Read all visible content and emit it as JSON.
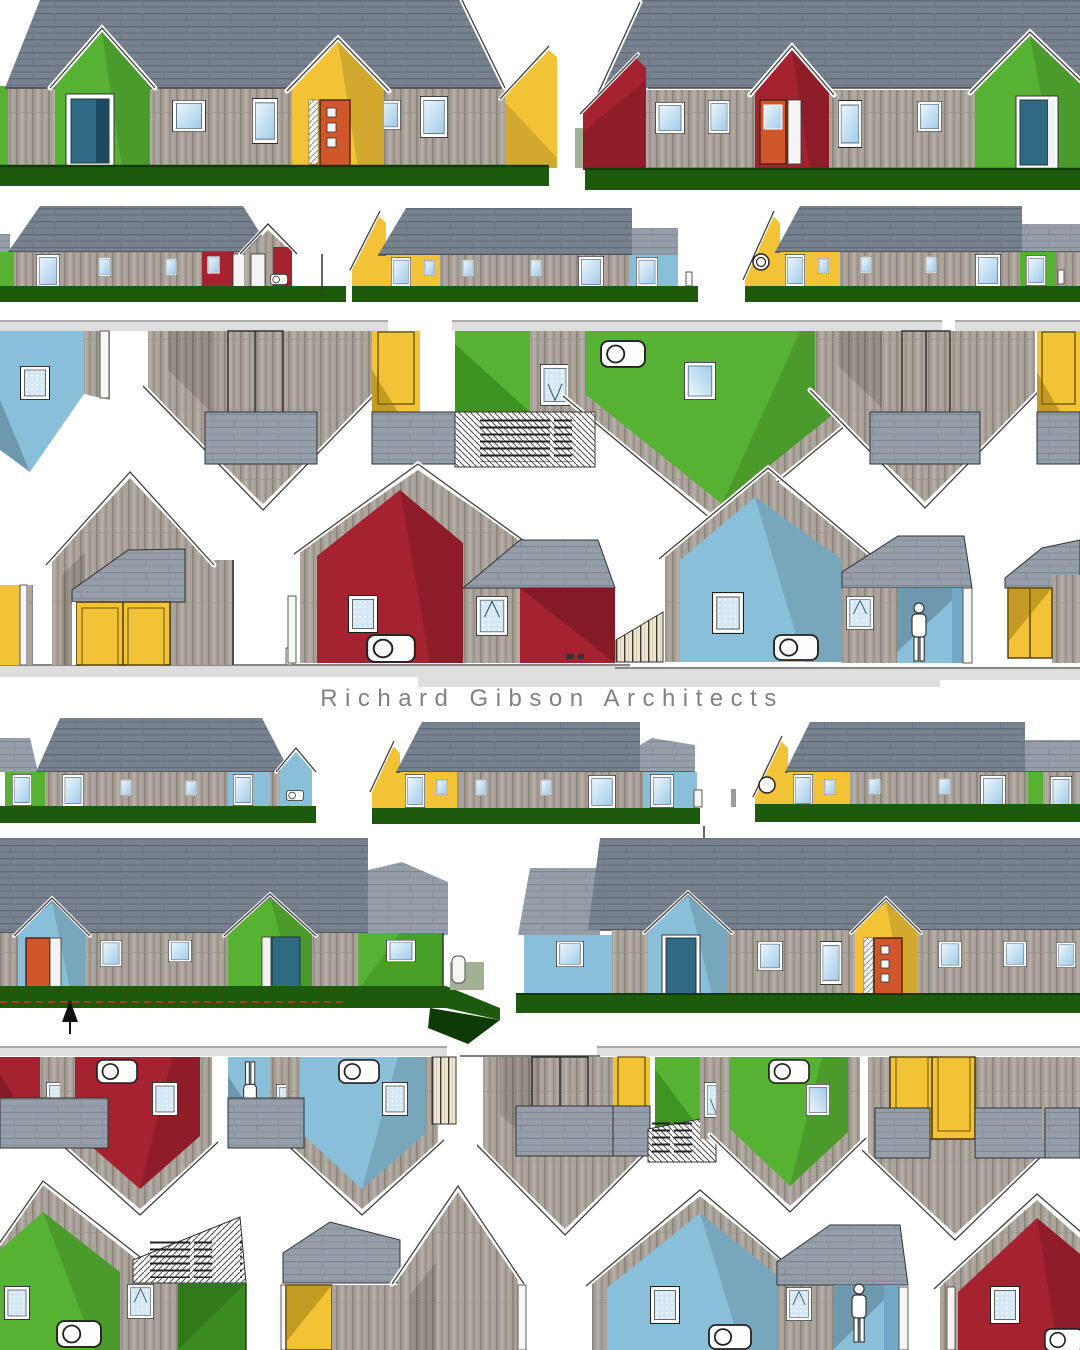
{
  "poster": {
    "title": "Richard Gibson Architects",
    "description": "collage of colourful house elevation drawings"
  },
  "palette": {
    "roofBase": "#78818e",
    "roofLine": "#5f6977",
    "roofLightBase": "#959ea9",
    "roofLightLine": "#7e8894",
    "woodBase": "#a8a199",
    "woodDark": "#8f887d",
    "woodLight": "#b6afa7",
    "woodMid": "#998f83",
    "green": "#57b233",
    "greenShade": "#3a8c1e",
    "yellow": "#f2c237",
    "red": "#a52230",
    "blue": "#8abfd9",
    "blueShade": "#6fa9c7",
    "tealDoor": "#2e6b83",
    "orangeDoor": "#d0562b",
    "grass": "#1d5a0e",
    "grassDark": "#0f3d05",
    "ground": "#dedede",
    "sage": "#a2b094",
    "fenceBeige": "#efe6d0",
    "datumRed": "#cc3a28",
    "outline": "#2a2a2a",
    "titleText": "#818181",
    "glassLight": "#eef6fd",
    "glassBlue": "#9fcbe9",
    "dotGlass": "#d4e7f4",
    "dottedTan": "#c9a26b"
  }
}
